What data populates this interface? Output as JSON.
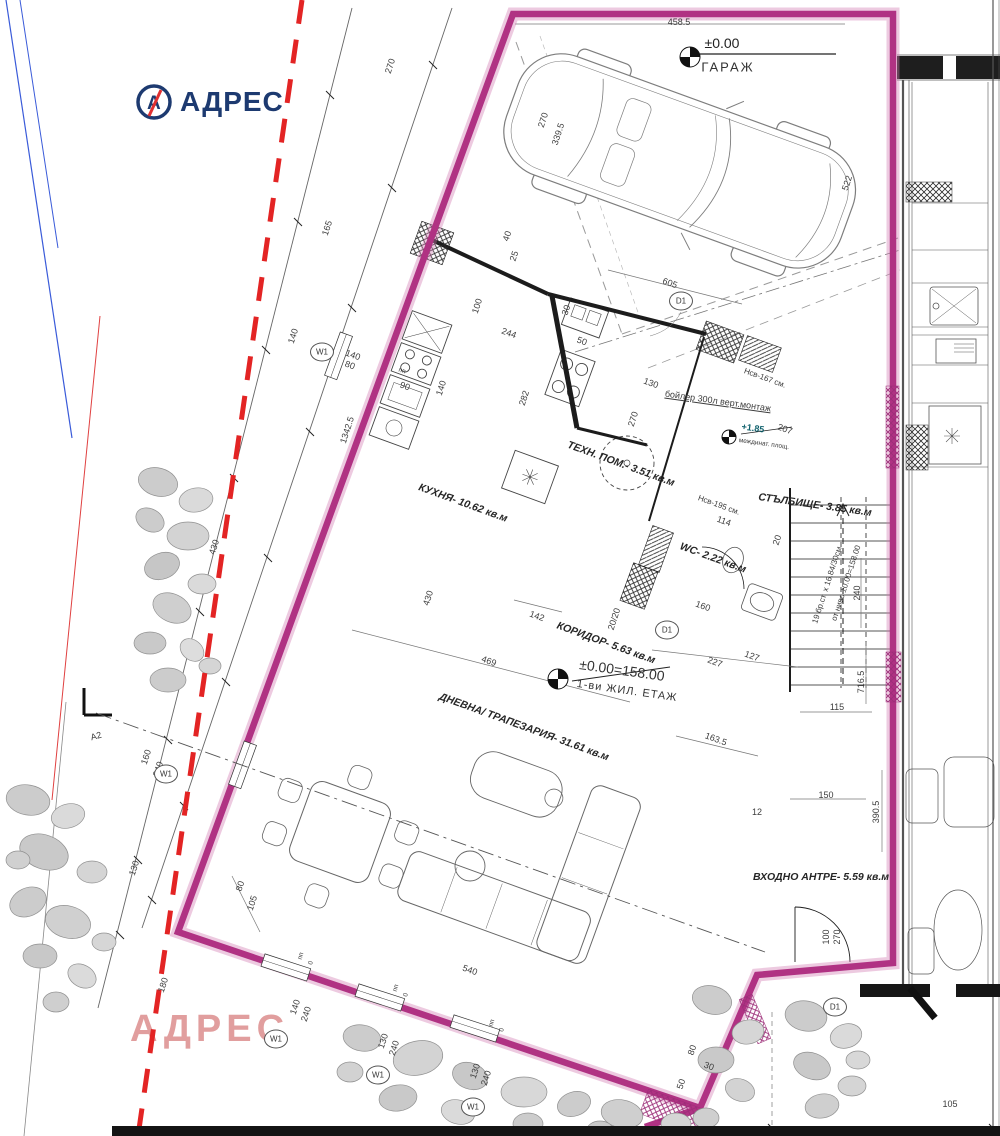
{
  "brand": {
    "logo_text": "АДРЕС",
    "logo_color": "#1d3a70",
    "logo_slash_color": "#e03030",
    "watermark_text": "АДРЕС",
    "watermark_color": "#dc8e8e"
  },
  "colors": {
    "boundary": "#b03283",
    "boundary_glow": "#d27ab2",
    "red_dashed": "#e32424",
    "blue_line": "#3a5bd9",
    "red_thin": "#e04040"
  },
  "summary": {
    "rooms": [
      {
        "name": "ГАРАЖ",
        "level": "±0.00"
      },
      {
        "name": "КУХНЯ",
        "area_sqm": "10.62"
      },
      {
        "name": "ТЕХН. ПОМ.",
        "area_sqm": "3.51"
      },
      {
        "name": "СТЪЛБИЩЕ",
        "area_sqm": "3.85"
      },
      {
        "name": "WC",
        "area_sqm": "2.22"
      },
      {
        "name": "КОРИДОР",
        "area_sqm": "5.63"
      },
      {
        "name": "ДНЕВНА/ ТРАПЕЗАРИЯ",
        "area_sqm": "31.61"
      },
      {
        "name": "ВХОДНО АНТРЕ",
        "area_sqm": "5.59"
      }
    ],
    "levels": [
      "±0.00 ГАРАЖ",
      "±0.00=158.00 1-ви ЖИЛ. ЕТАЖ",
      "+1.85 междинат. площ."
    ],
    "notes": [
      "бойлер 300л верт.монтаж",
      "19 бр.ст. х 16.84/30см",
      "от ниво ±0.00=158.00",
      "Нсв-167 см.",
      "Нсв-195 см."
    ]
  },
  "plan": {
    "labels": [
      {
        "t": "КУХНЯ- 10.62 кв.м",
        "x": 463,
        "y": 503,
        "r": 20,
        "c": "room",
        "n": "room-label-kitchen"
      },
      {
        "t": "ТЕХН. ПОМ.- 3.51 кв.м",
        "x": 621,
        "y": 464,
        "r": 20,
        "c": "room",
        "n": "room-label-tech-room"
      },
      {
        "t": "СТЪЛБИЩЕ- 3.85 кв.м",
        "x": 815,
        "y": 505,
        "r": 8,
        "c": "room",
        "n": "room-label-staircase"
      },
      {
        "t": "WC- 2.22 кв.м",
        "x": 713,
        "y": 558,
        "r": 20,
        "c": "room",
        "n": "room-label-wc"
      },
      {
        "t": "КОРИДОР- 5.63 кв.м",
        "x": 606,
        "y": 643,
        "r": 20,
        "c": "room",
        "n": "room-label-corridor"
      },
      {
        "t": "ДНЕВНА/ ТРАПЕЗАРИЯ- 31.61 кв.м",
        "x": 524,
        "y": 727,
        "r": 20,
        "c": "room",
        "n": "room-label-living-dining"
      },
      {
        "t": "ВХОДНО АНТРЕ- 5.59 кв.м",
        "x": 821,
        "y": 877,
        "r": 0,
        "c": "room",
        "n": "room-label-entry-hall"
      },
      {
        "t": "ГАРАЖ",
        "x": 728,
        "y": 67,
        "r": 0,
        "c": "roomlg",
        "n": "room-label-garage"
      },
      {
        "t": "±0.00",
        "x": 722,
        "y": 43,
        "r": 0,
        "c": "level",
        "n": "garage-level-label"
      },
      {
        "t": "±0.00=158.00",
        "x": 622,
        "y": 670,
        "r": 8,
        "c": "levellg",
        "n": "floor-level-label"
      },
      {
        "t": "1-ви ЖИЛ. ЕТАЖ",
        "x": 627,
        "y": 691,
        "r": 8,
        "c": "level2",
        "n": "floor-name-label"
      },
      {
        "t": "+1.85",
        "x": 753,
        "y": 428,
        "r": 8,
        "c": "levelsm",
        "n": "landing-level-label"
      },
      {
        "t": "междинат. площ.",
        "x": 764,
        "y": 444,
        "r": 8,
        "c": "tiny"
      },
      {
        "t": "бойлер 300л верт.монтаж",
        "x": 718,
        "y": 401,
        "r": 8,
        "c": "note-u",
        "n": "boiler-note"
      },
      {
        "t": "Нсв-167 см.",
        "x": 765,
        "y": 378,
        "r": 20,
        "c": "note"
      },
      {
        "t": "Нсв-195 см.",
        "x": 719,
        "y": 505,
        "r": 20,
        "c": "note"
      },
      {
        "t": "114",
        "x": 724,
        "y": 521,
        "r": 20,
        "c": "dim"
      },
      {
        "t": "19 бр.ст. х 16.84/30см",
        "x": 827,
        "y": 585,
        "r": -72,
        "c": "note",
        "n": "stairs-note"
      },
      {
        "t": "от ниво ±0.00=158.00",
        "x": 846,
        "y": 583,
        "r": -72,
        "c": "note"
      },
      {
        "t": "458.5",
        "x": 679,
        "y": 22,
        "r": 0,
        "c": "dim"
      },
      {
        "t": "270",
        "x": 390,
        "y": 66,
        "r": -72,
        "c": "dim"
      },
      {
        "t": "270",
        "x": 543,
        "y": 120,
        "r": -72,
        "c": "dim"
      },
      {
        "t": "339.5",
        "x": 558,
        "y": 134,
        "r": -72,
        "c": "dim"
      },
      {
        "t": "522",
        "x": 847,
        "y": 183,
        "r": -72,
        "c": "dim"
      },
      {
        "t": "165",
        "x": 327,
        "y": 228,
        "r": -72,
        "c": "dim"
      },
      {
        "t": "140",
        "x": 293,
        "y": 336,
        "r": -72,
        "c": "dim"
      },
      {
        "t": "1342.5",
        "x": 347,
        "y": 430,
        "r": -72,
        "c": "dim"
      },
      {
        "t": "430",
        "x": 214,
        "y": 547,
        "r": -72,
        "c": "dim"
      },
      {
        "t": "430",
        "x": 428,
        "y": 598,
        "r": -72,
        "c": "dim"
      },
      {
        "t": "160",
        "x": 146,
        "y": 757,
        "r": -72,
        "c": "dim"
      },
      {
        "t": "240",
        "x": 158,
        "y": 769,
        "r": -72,
        "c": "dim"
      },
      {
        "t": "130",
        "x": 134,
        "y": 868,
        "r": -72,
        "c": "dim"
      },
      {
        "t": "180",
        "x": 163,
        "y": 985,
        "r": -72,
        "c": "dim"
      },
      {
        "t": "80",
        "x": 240,
        "y": 886,
        "r": -72,
        "c": "dim"
      },
      {
        "t": "105",
        "x": 252,
        "y": 903,
        "r": -72,
        "c": "dim"
      },
      {
        "t": "140",
        "x": 353,
        "y": 355,
        "r": 20,
        "c": "dim"
      },
      {
        "t": "80",
        "x": 350,
        "y": 365,
        "r": 20,
        "c": "dim"
      },
      {
        "t": "пп",
        "x": 402,
        "y": 371,
        "r": 20,
        "c": "tiny"
      },
      {
        "t": "90",
        "x": 405,
        "y": 386,
        "r": 20,
        "c": "dim"
      },
      {
        "t": "140",
        "x": 441,
        "y": 388,
        "r": -72,
        "c": "dim"
      },
      {
        "t": "100",
        "x": 477,
        "y": 306,
        "r": -72,
        "c": "dim"
      },
      {
        "t": "244",
        "x": 509,
        "y": 333,
        "r": 20,
        "c": "dim"
      },
      {
        "t": "30",
        "x": 566,
        "y": 310,
        "r": -72,
        "c": "dim"
      },
      {
        "t": "50",
        "x": 582,
        "y": 341,
        "r": 20,
        "c": "dim"
      },
      {
        "t": "282",
        "x": 524,
        "y": 398,
        "r": -72,
        "c": "dim"
      },
      {
        "t": "40",
        "x": 507,
        "y": 236,
        "r": -72,
        "c": "dim"
      },
      {
        "t": "25",
        "x": 514,
        "y": 256,
        "r": -72,
        "c": "dim"
      },
      {
        "t": "130",
        "x": 651,
        "y": 383,
        "r": 20,
        "c": "dim"
      },
      {
        "t": "270",
        "x": 633,
        "y": 419,
        "r": -72,
        "c": "dim"
      },
      {
        "t": "605",
        "x": 670,
        "y": 283,
        "r": 20,
        "c": "dim"
      },
      {
        "t": "207",
        "x": 785,
        "y": 429,
        "r": 20,
        "c": "dim"
      },
      {
        "t": "20",
        "x": 777,
        "y": 540,
        "r": -72,
        "c": "dim"
      },
      {
        "t": "20/20",
        "x": 614,
        "y": 619,
        "r": -72,
        "c": "dim"
      },
      {
        "t": "160",
        "x": 703,
        "y": 606,
        "r": 20,
        "c": "dim"
      },
      {
        "t": "142",
        "x": 537,
        "y": 616,
        "r": 20,
        "c": "dim"
      },
      {
        "t": "227",
        "x": 715,
        "y": 662,
        "r": 20,
        "c": "dim"
      },
      {
        "t": "127",
        "x": 752,
        "y": 656,
        "r": 20,
        "c": "dim"
      },
      {
        "t": "469",
        "x": 489,
        "y": 661,
        "r": 20,
        "c": "dim"
      },
      {
        "t": "163.5",
        "x": 716,
        "y": 739,
        "r": 20,
        "c": "dim"
      },
      {
        "t": "716.5",
        "x": 861,
        "y": 682,
        "r": -90,
        "c": "dim"
      },
      {
        "t": "115",
        "x": 837,
        "y": 707,
        "r": 0,
        "c": "dim"
      },
      {
        "t": "150",
        "x": 826,
        "y": 795,
        "r": 0,
        "c": "dim"
      },
      {
        "t": "390.5",
        "x": 876,
        "y": 812,
        "r": -90,
        "c": "dim"
      },
      {
        "t": "240",
        "x": 857,
        "y": 593,
        "r": -90,
        "c": "dim"
      },
      {
        "t": "12",
        "x": 757,
        "y": 812,
        "r": 0,
        "c": "dim"
      },
      {
        "t": "100",
        "x": 826,
        "y": 937,
        "r": -90,
        "c": "dim"
      },
      {
        "t": "270",
        "x": 837,
        "y": 937,
        "r": -90,
        "c": "dim"
      },
      {
        "t": "540",
        "x": 470,
        "y": 970,
        "r": 20,
        "c": "dim"
      },
      {
        "t": "пп",
        "x": 301,
        "y": 956,
        "r": -72,
        "c": "tiny"
      },
      {
        "t": "0",
        "x": 311,
        "y": 963,
        "r": -72,
        "c": "tiny"
      },
      {
        "t": "пп",
        "x": 396,
        "y": 988,
        "r": -72,
        "c": "tiny"
      },
      {
        "t": "0",
        "x": 406,
        "y": 995,
        "r": -72,
        "c": "tiny"
      },
      {
        "t": "пп",
        "x": 492,
        "y": 1023,
        "r": -72,
        "c": "tiny"
      },
      {
        "t": "0",
        "x": 502,
        "y": 1030,
        "r": -72,
        "c": "tiny"
      },
      {
        "t": "140",
        "x": 295,
        "y": 1007,
        "r": -72,
        "c": "dim"
      },
      {
        "t": "240",
        "x": 306,
        "y": 1014,
        "r": -72,
        "c": "dim"
      },
      {
        "t": "130",
        "x": 383,
        "y": 1041,
        "r": -72,
        "c": "dim"
      },
      {
        "t": "240",
        "x": 394,
        "y": 1048,
        "r": -72,
        "c": "dim"
      },
      {
        "t": "130",
        "x": 475,
        "y": 1071,
        "r": -72,
        "c": "dim"
      },
      {
        "t": "240",
        "x": 486,
        "y": 1078,
        "r": -72,
        "c": "dim"
      },
      {
        "t": "80",
        "x": 692,
        "y": 1050,
        "r": -72,
        "c": "dim"
      },
      {
        "t": "30",
        "x": 709,
        "y": 1066,
        "r": 20,
        "c": "dim"
      },
      {
        "t": "50",
        "x": 681,
        "y": 1084,
        "r": -72,
        "c": "dim"
      },
      {
        "t": "105",
        "x": 950,
        "y": 1104,
        "r": 0,
        "c": "dim"
      },
      {
        "t": "А2",
        "x": 96,
        "y": 736,
        "r": -15,
        "c": "dim",
        "n": "section-marker-label"
      }
    ],
    "bubbles": [
      {
        "t": "W1",
        "x": 322,
        "y": 352
      },
      {
        "t": "W1",
        "x": 166,
        "y": 774
      },
      {
        "t": "W1",
        "x": 276,
        "y": 1039
      },
      {
        "t": "W1",
        "x": 378,
        "y": 1075
      },
      {
        "t": "W1",
        "x": 473,
        "y": 1107
      },
      {
        "t": "D1",
        "x": 681,
        "y": 301
      },
      {
        "t": "D1",
        "x": 667,
        "y": 630
      },
      {
        "t": "D1",
        "x": 835,
        "y": 1007
      }
    ]
  }
}
